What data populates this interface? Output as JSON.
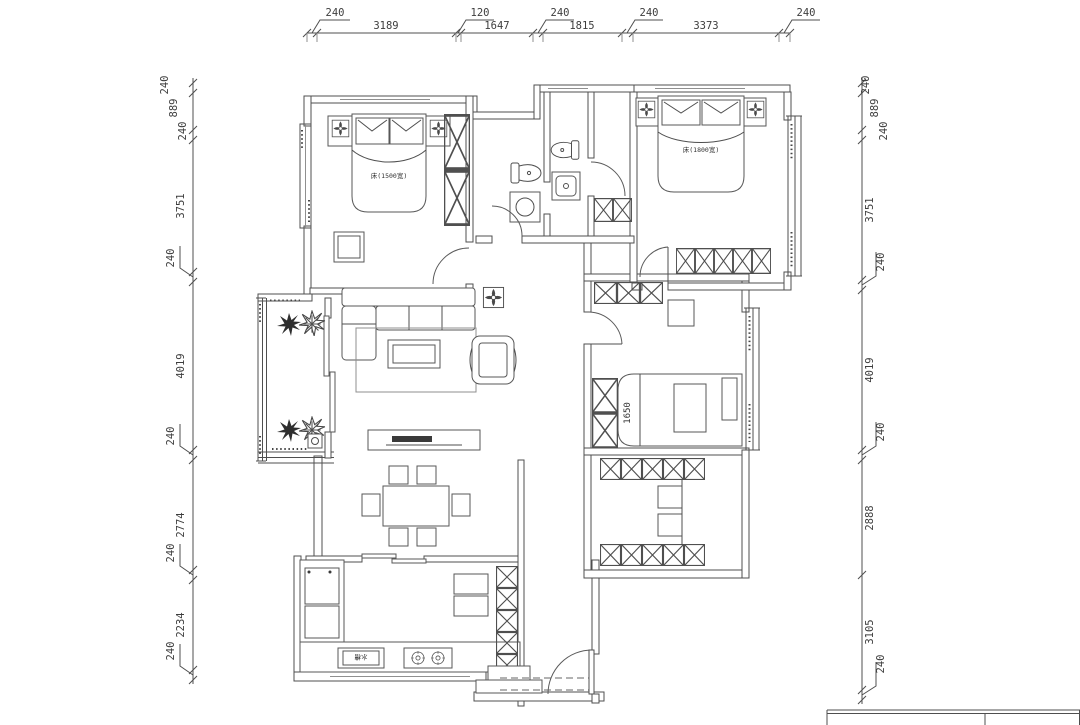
{
  "page": {
    "background": "#ffffff"
  },
  "colors": {
    "line": "#4f4f4f",
    "light_line": "#8f8f8f",
    "dark_fill": "#3a3a3a"
  },
  "dims": {
    "top": [
      "240",
      "3189",
      "120",
      "1647",
      "240",
      "1815",
      "240",
      "3373",
      "240"
    ],
    "left": [
      "240",
      "889",
      "240",
      "3751",
      "240",
      "4019",
      "240",
      "2774",
      "240",
      "2234",
      "240"
    ],
    "right": [
      "240",
      "889",
      "240",
      "3751",
      "240",
      "4019",
      "240",
      "2888",
      "3105",
      "240"
    ]
  },
  "labels": {
    "bed_small": "床(1500宽)",
    "bed_large": "床(1800宽)",
    "bed_mid_width": "1650",
    "kitchen_sink": "水槽"
  }
}
